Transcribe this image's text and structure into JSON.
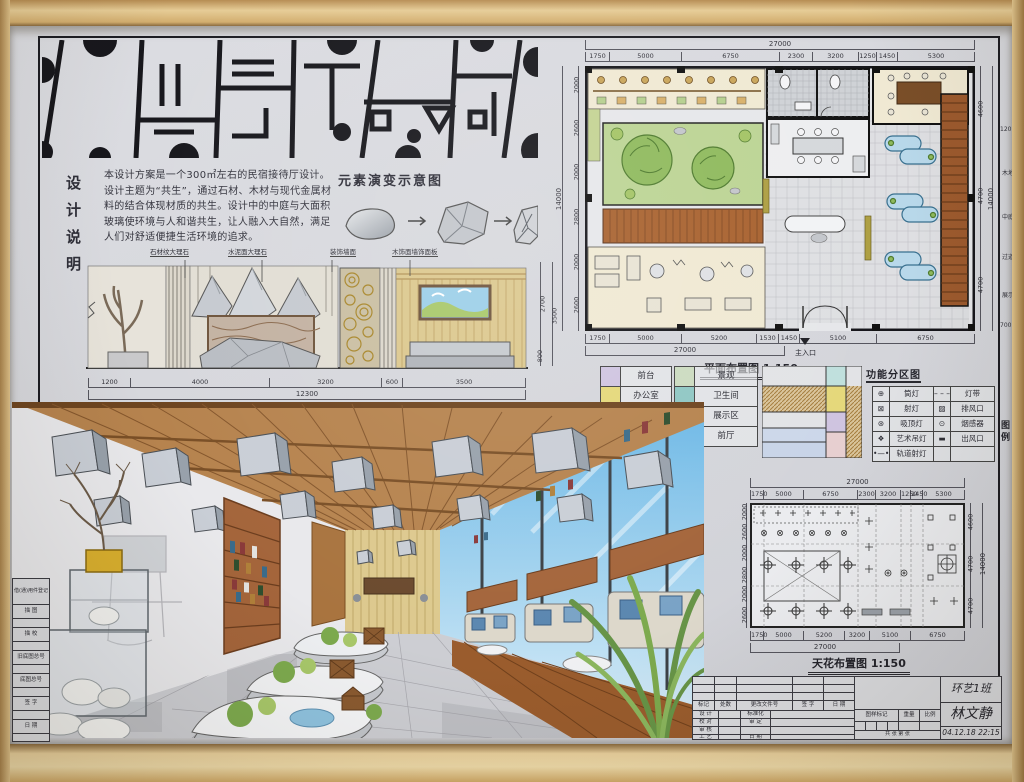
{
  "design_notes": {
    "c0": "设",
    "c1": "计",
    "c2": "说",
    "c3": "明",
    "text": "本设计方案是一个300㎡左右的民宿接待厅设计。设计主题为“共生”，通过石材、木材与现代金属材料的结合体现材质的共生。设计中的中庭与大面积玻璃使环境与人和谐共生，让人融入大自然，满足人们对舒适便捷生活环境的追求。"
  },
  "evolution": {
    "title": "元素演变示意图"
  },
  "elevation": {
    "callout_stone": "石材纹大理石",
    "callout_cement": "水泥面大理石",
    "callout_deco": "装饰墙面",
    "callout_wood": "木饰面墙饰面板",
    "dims_bottom": [
      "1200",
      "4000",
      "3200",
      "600",
      "3500"
    ],
    "dim_total": "12300",
    "dims_right": [
      "2700",
      "800"
    ],
    "dim_right_total": "3500",
    "caption": "立面图 1:75"
  },
  "floor_plan": {
    "caption": "平面布置图 1:150",
    "dim_total_top": "27000",
    "dims_top": [
      "1750",
      "5000",
      "6750",
      "2300",
      "3200",
      "1250",
      "1450",
      "5300"
    ],
    "dims_left": [
      "2000",
      "2600",
      "2000",
      "2800",
      "2000",
      "2600"
    ],
    "dim_total_left": "14000",
    "dims_right": [
      "4600",
      "4700",
      "4700"
    ],
    "dim_total_right": "14000",
    "dims_bottom": [
      "1750",
      "5000",
      "5200",
      "1530",
      "1450",
      "5100",
      "6750"
    ],
    "dim_total_bottom": "27000",
    "entrance": "主入口",
    "annotations": [
      "120×120",
      "木地板",
      "中庭",
      "过道",
      "展示区",
      "700×700"
    ]
  },
  "zones": {
    "title": "功能分区图",
    "left": [
      {
        "label": "前台",
        "color": "#cfc4e0"
      },
      {
        "label": "办公室",
        "color": "#e5d87a"
      },
      {
        "label": "休息区",
        "color": "#c3cfe0"
      }
    ],
    "right": [
      {
        "label": "景观",
        "color": "#ccdbc0"
      },
      {
        "label": "卫生间",
        "color": "#8fc7c3"
      },
      {
        "label": "展示区",
        "color": "#c9a96a"
      },
      {
        "label": "前厅",
        "color": "#e7cfd0"
      }
    ]
  },
  "legend": {
    "side": "图例",
    "r0s": "⊕",
    "r0n": "筒灯",
    "r0s2": "– – –",
    "r0n2": "灯带",
    "r1s": "⊠",
    "r1n": "射灯",
    "r1s2": "▨",
    "r1n2": "排风口",
    "r2s": "⊛",
    "r2n": "吸顶灯",
    "r2s2": "⊙",
    "r2n2": "烟感器",
    "r3s": "❖",
    "r3n": "艺术吊灯",
    "r3s2": "▬",
    "r3n2": "出风口",
    "r4s": "•—•",
    "r4n": "轨道射灯"
  },
  "ceiling_plan": {
    "caption": "天花布置图 1:150",
    "dim_total_top": "27000",
    "dims_top": [
      "1750",
      "5000",
      "6750",
      "2300",
      "3200",
      "1250",
      "1450",
      "5300"
    ],
    "dims_bottom": [
      "1750",
      "5000",
      "5200",
      "3200",
      "5100",
      "6750"
    ],
    "dim_total_bottom": "27000",
    "dims_left": [
      "2000",
      "2600",
      "2000",
      "2800",
      "2000",
      "2600"
    ],
    "dims_right": [
      "4600",
      "4700",
      "4700"
    ],
    "dim_total_right": "14000"
  },
  "titleblock": {
    "h0": "标记",
    "h1": "处数",
    "h2": "更改文件号",
    "h3": "签 字",
    "h4": "日 期",
    "r0a": "设 计",
    "r0b": "标准化",
    "r1a": "校 对",
    "r1b": "审 定",
    "r2a": "审 核",
    "r3a": "工 艺",
    "r3b": "日 期",
    "mark": "图样标记",
    "weight": "重量",
    "scale": "比例",
    "sheets": "共 张 第 张",
    "class_name": "环艺1班",
    "author": "林文静",
    "date_note": "04.12.18 22:15"
  },
  "sideblock": {
    "f0": "借(通)用件登记",
    "f1": "描 图",
    "f2": "描 校",
    "f3": "旧底图总号",
    "f4": "底图总号",
    "f5": "签 字",
    "f6": "日 期"
  },
  "colors": {
    "paper": "#d7d8dc",
    "ink": "#26262c",
    "wood_frame": "#dcba7e",
    "wood_ceiling": "#b6834e",
    "deck_brown": "#9a5c2d",
    "courtyard_green": "#bcd494",
    "sky_blue": "#86c5ea",
    "island_blue": "#b8d8ea",
    "shelf_brown": "#9c5a2e",
    "gold": "#a8862a"
  }
}
